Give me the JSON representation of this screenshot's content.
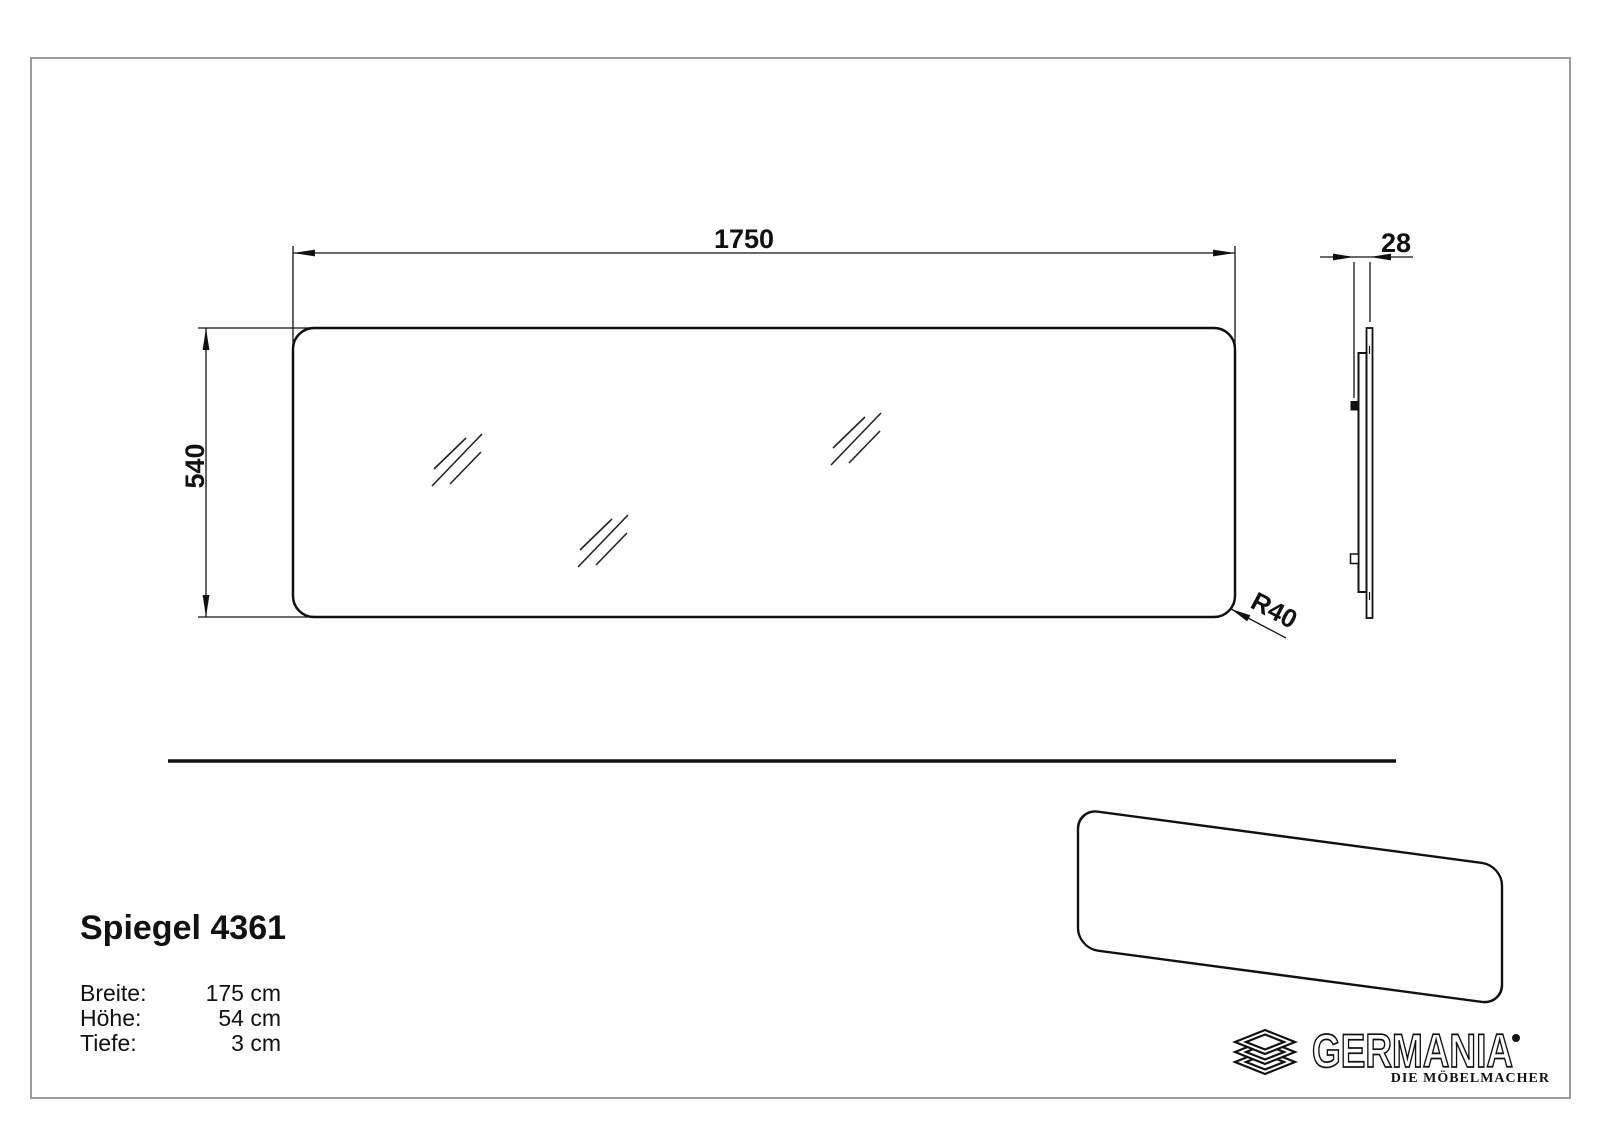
{
  "drawing": {
    "front_view": {
      "width": "1750",
      "height": "540",
      "corner_radius": "R40"
    },
    "side_view": {
      "depth": "28"
    }
  },
  "product": {
    "title": "Spiegel 4361",
    "specs": [
      {
        "label": "Breite:",
        "value": "175 cm"
      },
      {
        "label": "Höhe:",
        "value": "54 cm"
      },
      {
        "label": "Tiefe:",
        "value": "3 cm"
      }
    ]
  },
  "logo": {
    "brand": "GERMANIA",
    "tagline": "DIE MÖBELMACHER"
  },
  "colors": {
    "line": "#111111",
    "frame_border": "#9c9c9c",
    "background": "#ffffff"
  }
}
